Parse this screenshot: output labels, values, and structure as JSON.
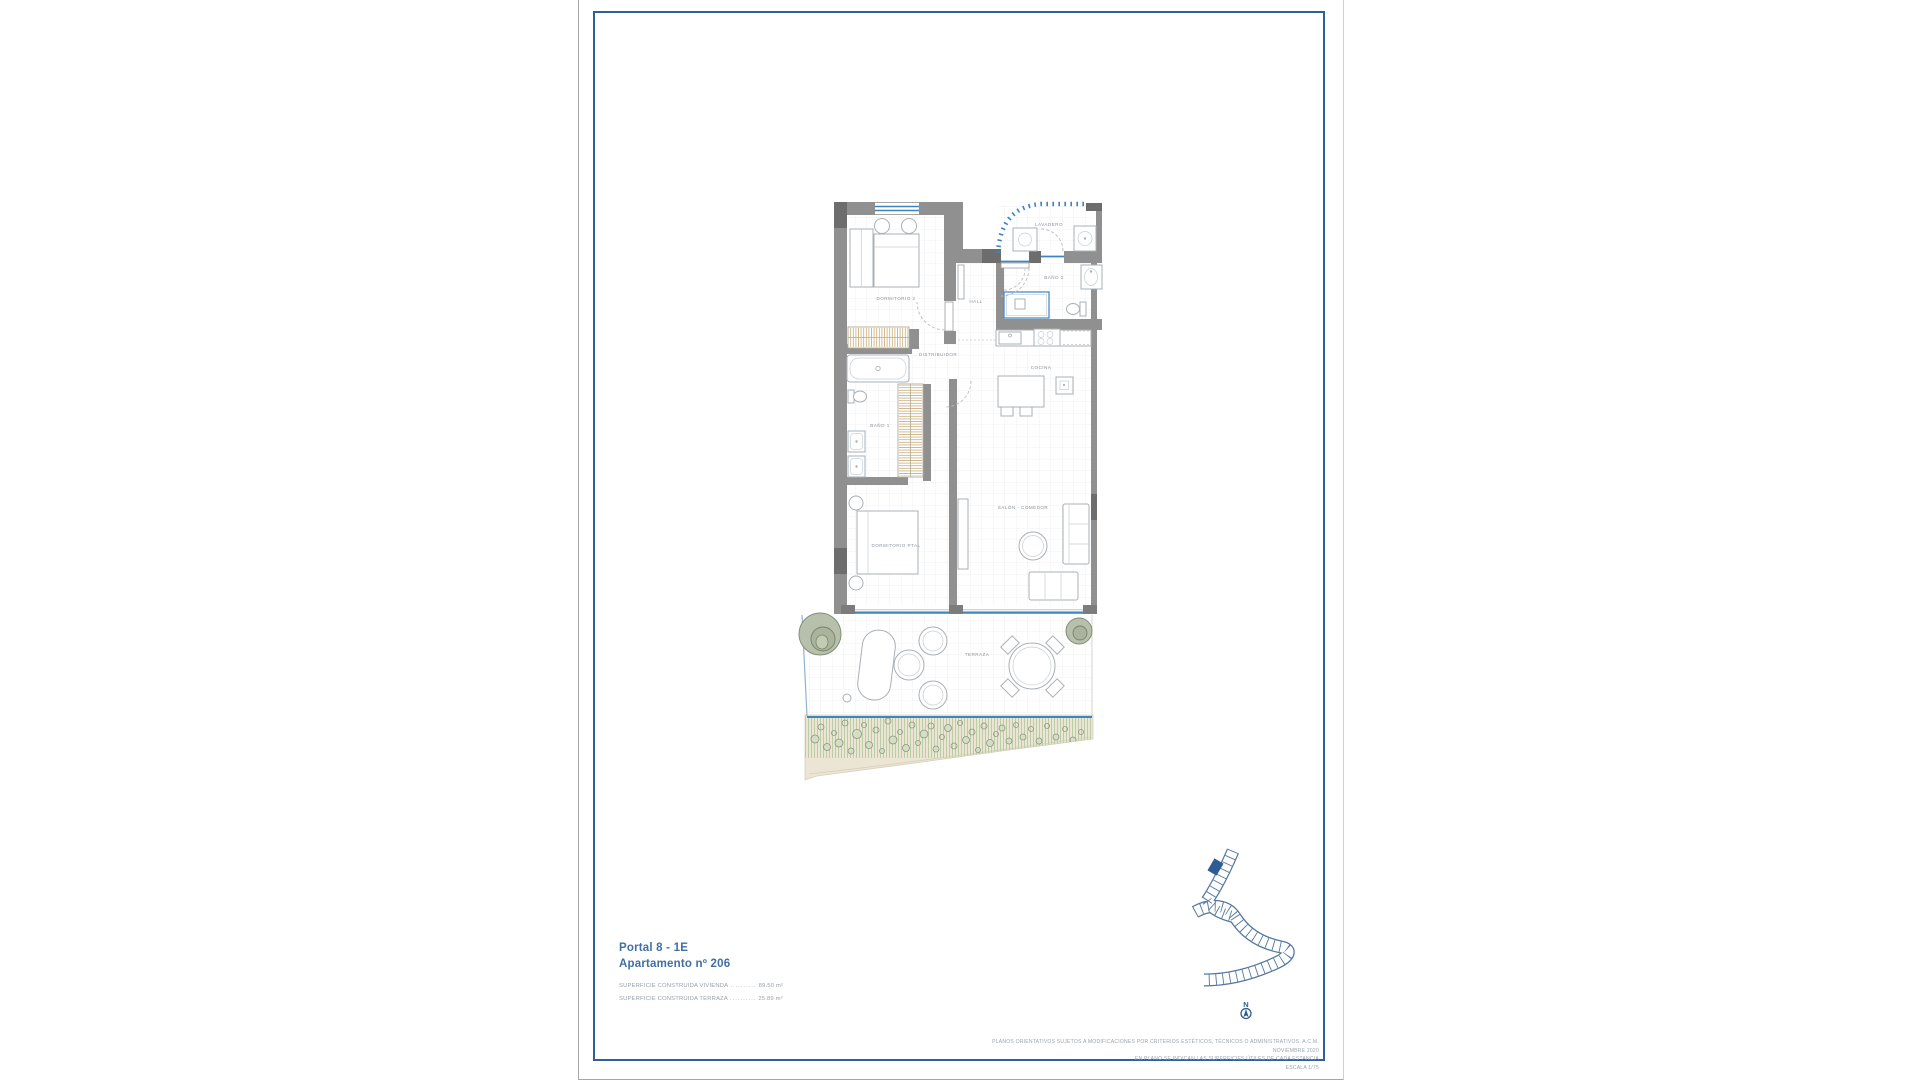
{
  "document": {
    "title_block": {
      "line1": "Portal 8 - 1E",
      "line2": "Apartamento nº 206"
    },
    "areas": [
      {
        "label": "SUPERFICIE CONSTRUIDA VIVIENDA",
        "leader": "..........",
        "value": "89.50 m²"
      },
      {
        "label": "SUPERFICIE CONSTRUIDA TERRAZA",
        "leader": "..........",
        "value": "25.89 m²"
      }
    ],
    "disclaimer": {
      "line1": "PLANOS ORIENTATIVOS SUJETOS A MODIFICACIONES POR CRITERIOS ESTÉTICOS, TÉCNICOS O ADMINISTRATIVOS. A.C.M. NOVIEMBRE 2020",
      "line2": "EN PLANO SE INDICAN LAS SUPERFICIES ÚTILES DE CADA ESTANCIA",
      "line3": "ESCALA 1/75"
    },
    "compass": {
      "north": "N"
    }
  },
  "plan": {
    "rooms": [
      {
        "label": "LAVADERO"
      },
      {
        "label": "BAÑO 2"
      },
      {
        "label": "HALL"
      },
      {
        "label": "DORMITORIO 2"
      },
      {
        "label": "DISTRIBUIDOR"
      },
      {
        "label": "COCINA"
      },
      {
        "label": "BAÑO 1"
      },
      {
        "label": "DORMITORIO PTAL"
      },
      {
        "label": "SALÓN - COMEDOR"
      },
      {
        "label": "TERRAZA"
      }
    ]
  },
  "colors": {
    "frame_blue": "#30609a",
    "wall_gray": "#909090",
    "window_blue": "#3e84bd",
    "title_blue": "#416fa5",
    "label_gray": "#8b939f",
    "plant_green": "#b7c0aa"
  }
}
